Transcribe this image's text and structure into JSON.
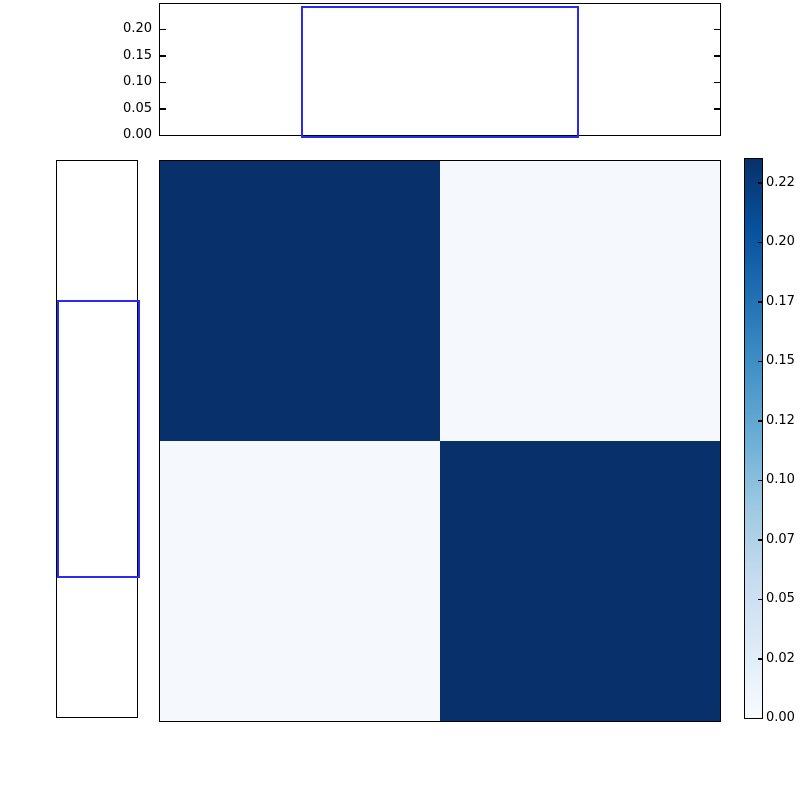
{
  "figure": {
    "title": "",
    "background": "#ffffff"
  },
  "colors": {
    "axis": "#000000",
    "text": "#000000",
    "step_line": "#2a2af0",
    "heat_high": "#08306b",
    "heat_low": "#f5f9fd",
    "blues_gradient": [
      "#f7fbff",
      "#deebf7",
      "#c6dbef",
      "#9ecae1",
      "#6baed6",
      "#4292c6",
      "#2171b5",
      "#08519c",
      "#08306b"
    ]
  },
  "chart_data": {
    "type": "heatmap",
    "title": "",
    "xlabel": "",
    "ylabel": "",
    "colormap": "Blues",
    "vmin": 0.0,
    "vmax": 0.235,
    "matrix": {
      "rows": 2,
      "cols": 2,
      "values": [
        [
          0.235,
          0.004
        ],
        [
          0.004,
          0.235
        ]
      ]
    },
    "colorbar": {
      "position": "right",
      "ticks": [
        {
          "value": 0.225,
          "label": "0.22"
        },
        {
          "value": 0.2,
          "label": "0.20"
        },
        {
          "value": 0.175,
          "label": "0.17"
        },
        {
          "value": 0.15,
          "label": "0.15"
        },
        {
          "value": 0.125,
          "label": "0.12"
        },
        {
          "value": 0.1,
          "label": "0.10"
        },
        {
          "value": 0.075,
          "label": "0.07"
        },
        {
          "value": 0.05,
          "label": "0.05"
        },
        {
          "value": 0.025,
          "label": "0.02"
        },
        {
          "value": 0.0,
          "label": "0.00"
        }
      ],
      "tick_scale_max": 0.2349
    },
    "top_marginal": {
      "type": "step-histogram",
      "line_color_name": "blue",
      "ylim": [
        0,
        0.2475
      ],
      "yticks": [
        {
          "value": 0.2,
          "label": "0.20"
        },
        {
          "value": 0.15,
          "label": "0.15"
        },
        {
          "value": 0.1,
          "label": "0.10"
        },
        {
          "value": 0.05,
          "label": "0.05"
        },
        {
          "value": 0.0,
          "label": "0.00"
        }
      ],
      "bar": {
        "start_frac": 0.251,
        "end_frac": 0.749,
        "height": 0.24
      }
    },
    "left_marginal": {
      "type": "step-histogram",
      "line_color_name": "blue",
      "xlim": [
        0,
        0.2475
      ],
      "inverted_axis": true,
      "bar": {
        "start_frac": 0.25,
        "end_frac": 0.75,
        "height": 0.24
      }
    }
  }
}
